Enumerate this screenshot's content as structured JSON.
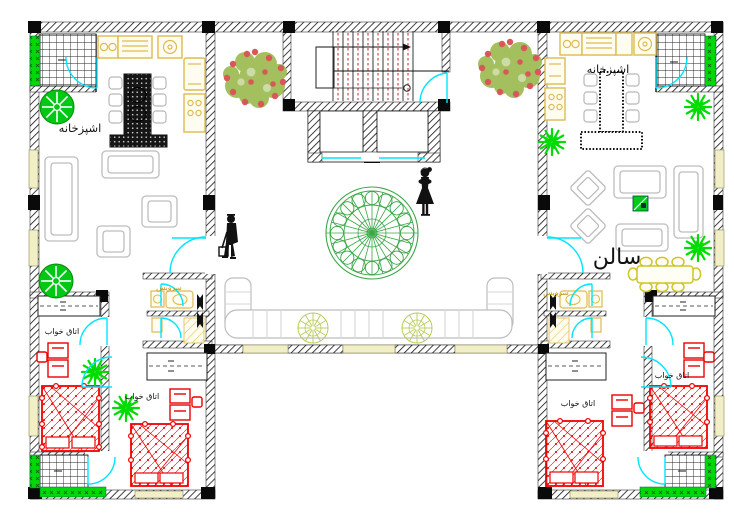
{
  "document": {
    "type": "architectural floor plan (CAD residential level)",
    "language": "fa"
  },
  "rooms": {
    "kitchen_left": {
      "label": "اشپزخانه"
    },
    "kitchen_right": {
      "label": "اشپزخانه"
    },
    "salon_right": {
      "label": "سالن"
    },
    "wc_left": {
      "label": "سرویس"
    },
    "wc_right": {
      "label": "سرویس"
    },
    "bedroom_bl_outer": {
      "label": "اتاق خواب"
    },
    "bedroom_bl_inner": {
      "label": "اتاق خواب"
    },
    "bedroom_br_inner": {
      "label": "اتاق خواب"
    },
    "bedroom_br_outer": {
      "label": "اتاق خواب"
    }
  },
  "colors": {
    "wall": "#111111",
    "door": "#00E5FF",
    "bed_furniture": "#F00000",
    "kitchen_fixture": "#DDBA52",
    "window_sill": "#F2EEC6",
    "tree": "#00C814",
    "shrub_spiky": "#00DC00",
    "bush_foliage": "#A4C05E",
    "bush_berries": "#D85858",
    "mandala": "#3AA746",
    "courtyard_plant": "#B9CB5E",
    "sofa_outline": "#BDBDBD",
    "stair_tread_dash": "#D04848",
    "wc_label": "#C09000"
  }
}
